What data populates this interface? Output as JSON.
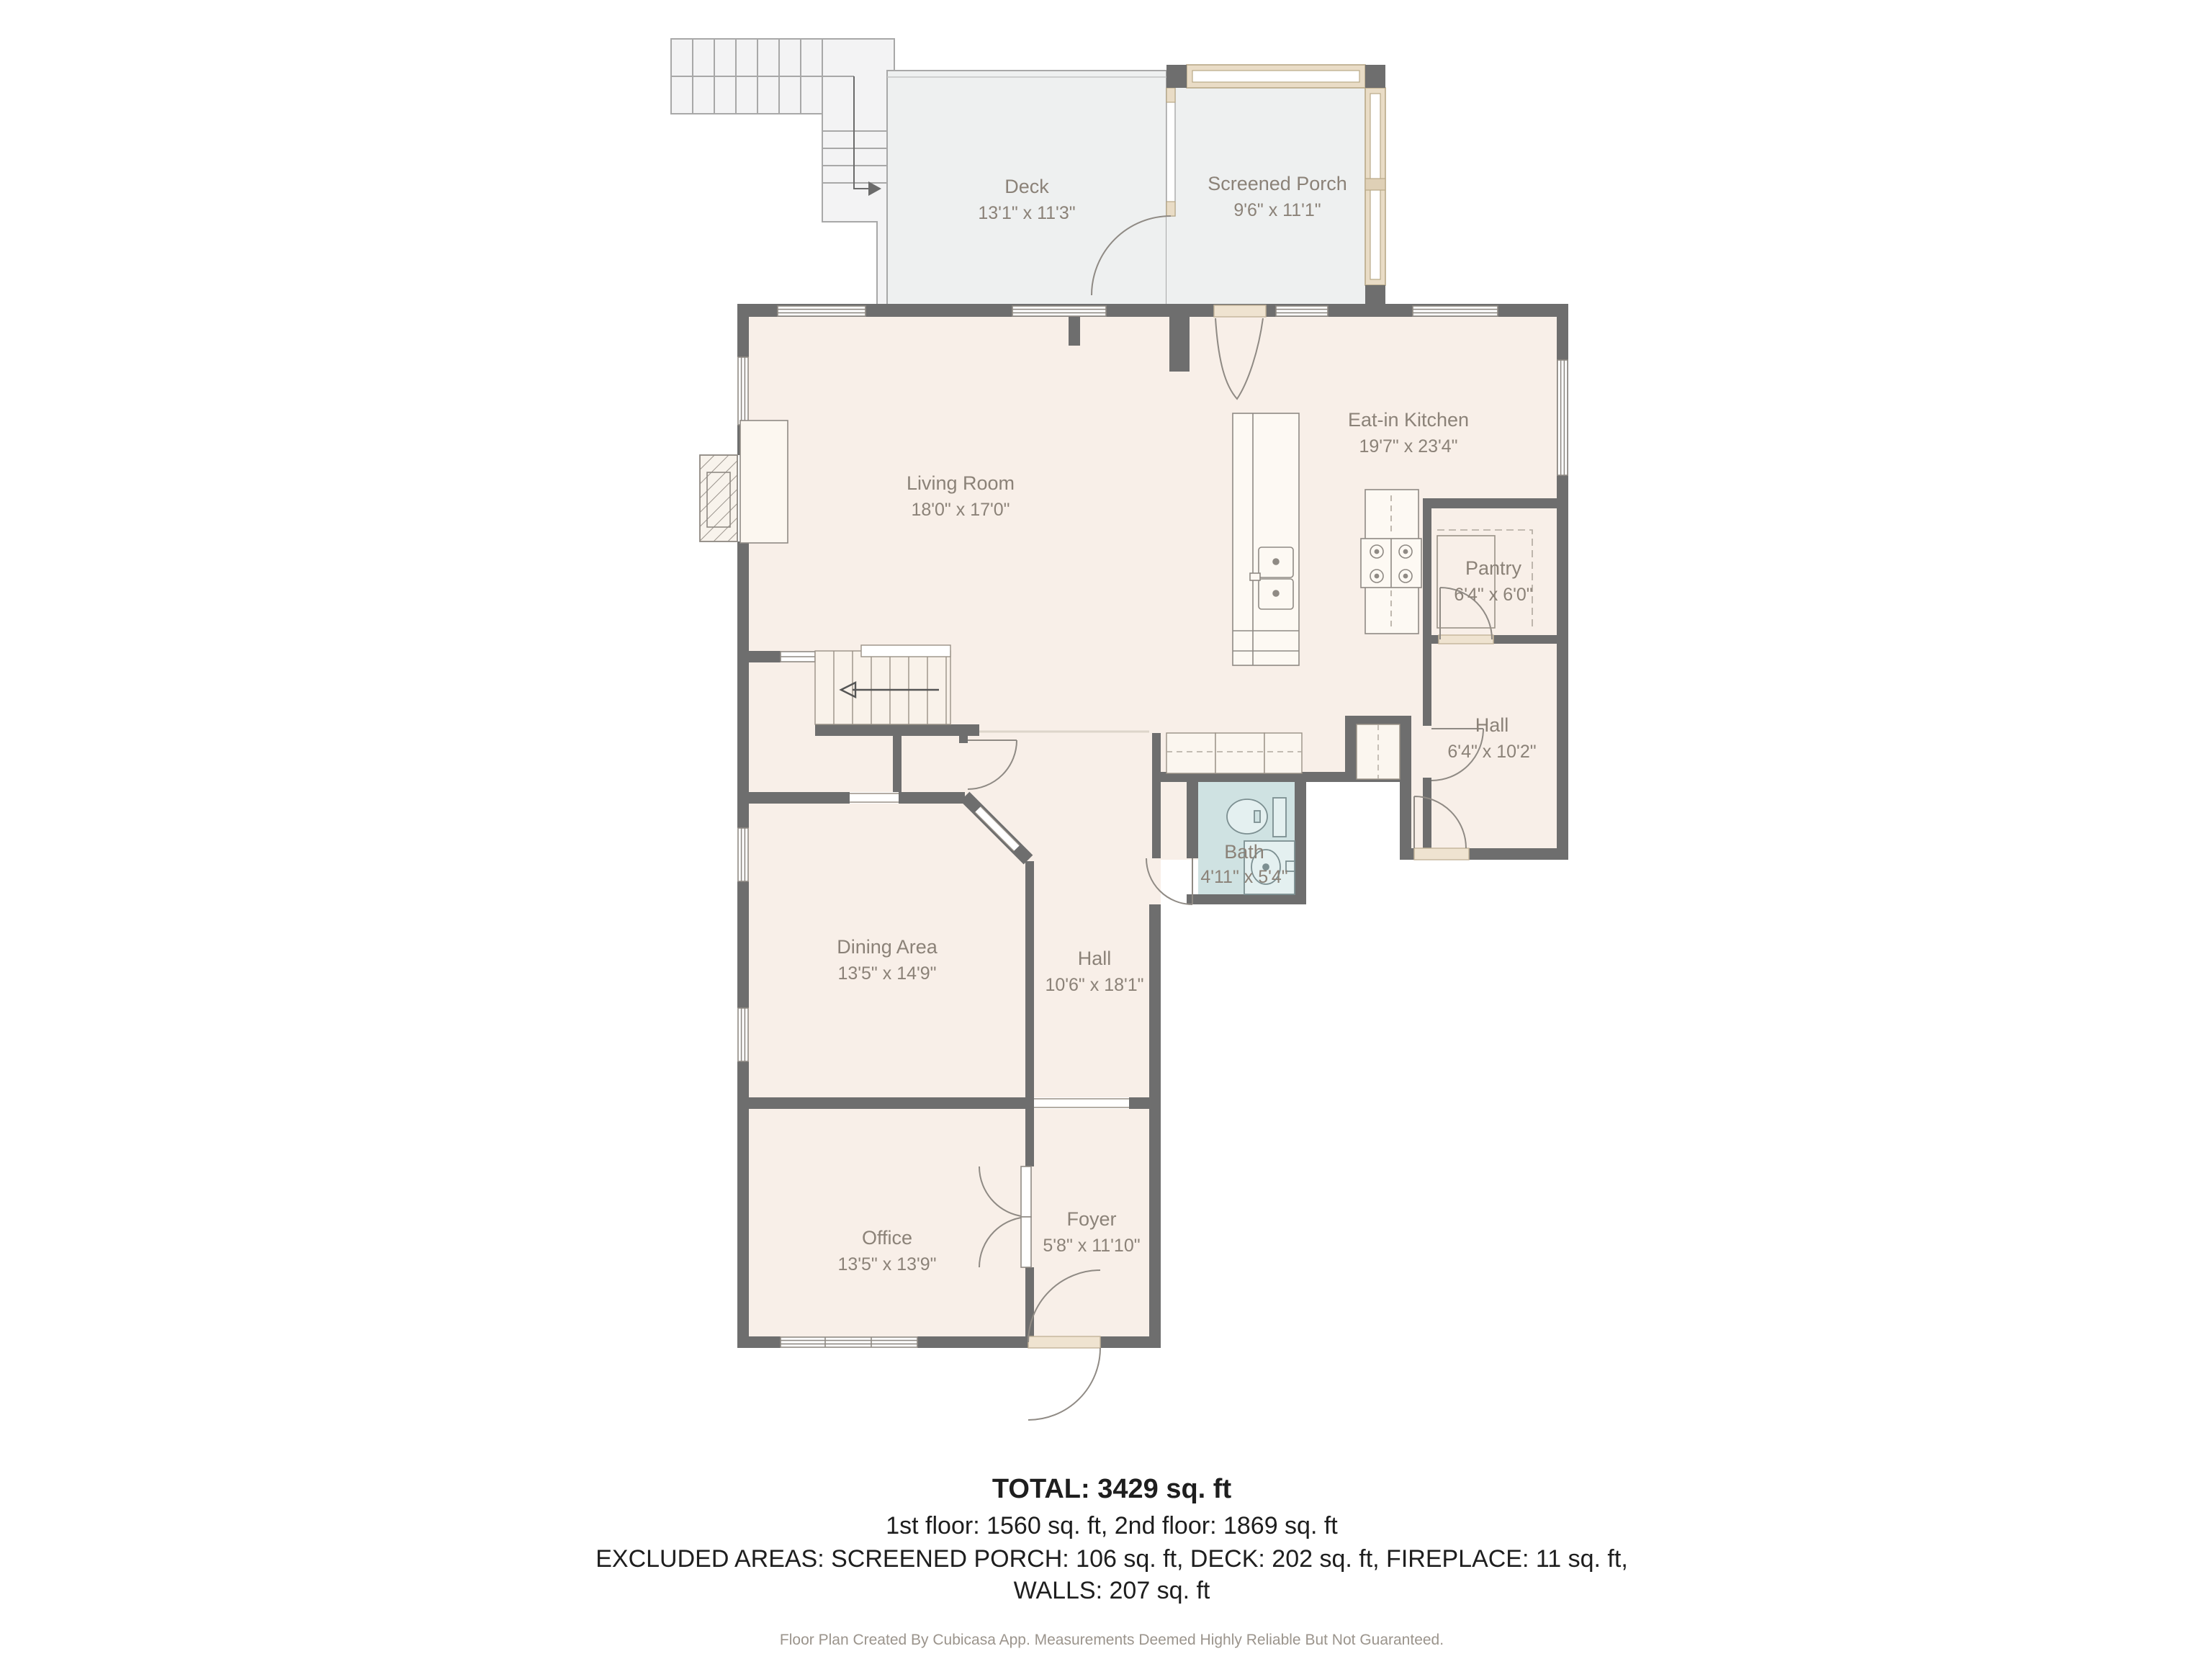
{
  "rooms": {
    "deck": {
      "name": "Deck",
      "dims": "13'1\" x 11'3\""
    },
    "porch": {
      "name": "Screened Porch",
      "dims": "9'6\" x 11'1\""
    },
    "living": {
      "name": "Living Room",
      "dims": "18'0\" x 17'0\""
    },
    "kitchen": {
      "name": "Eat-in Kitchen",
      "dims": "19'7\" x 23'4\""
    },
    "pantry": {
      "name": "Pantry",
      "dims": "6'4\" x 6'0\""
    },
    "hall_right": {
      "name": "Hall",
      "dims": "6'4\" x 10'2\""
    },
    "bath": {
      "name": "Bath",
      "dims": "4'11\" x 5'4\""
    },
    "hall_center": {
      "name": "Hall",
      "dims": "10'6\" x 18'1\""
    },
    "dining": {
      "name": "Dining Area",
      "dims": "13'5\" x 14'9\""
    },
    "office": {
      "name": "Office",
      "dims": "13'5\" x 13'9\""
    },
    "foyer": {
      "name": "Foyer",
      "dims": "5'8\" x 11'10\""
    }
  },
  "summary": {
    "total": "TOTAL: 3429 sq. ft",
    "floors": "1st floor: 1560 sq. ft, 2nd floor: 1869 sq. ft",
    "excluded": "EXCLUDED AREAS: SCREENED PORCH: 106 sq. ft, DECK: 202 sq. ft, FIREPLACE: 11 sq. ft,",
    "walls": "WALLS: 207 sq. ft"
  },
  "footer": {
    "disclaimer": "Floor Plan Created By Cubicasa App. Measurements Deemed Highly Reliable But Not Guaranteed."
  },
  "colors": {
    "walls": "#6e6e6e",
    "floor": "#f8efe8",
    "deck": "#eef0f0",
    "bath": "#cfe2e2",
    "beige": "#e9dcc6",
    "label": "#8b8278"
  }
}
